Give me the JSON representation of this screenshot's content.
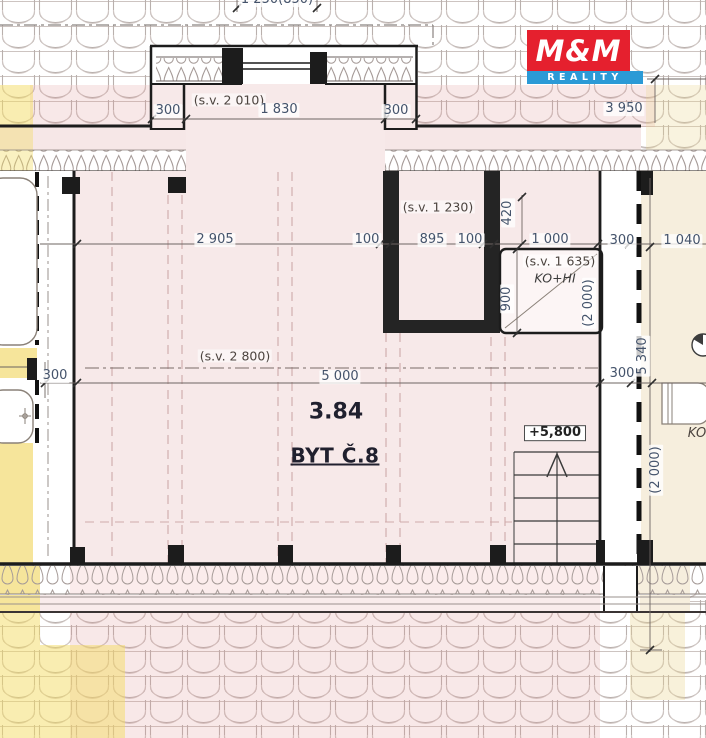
{
  "logo": {
    "name": "M&M",
    "tagline": "REALITY"
  },
  "colors": {
    "logo-red": "#e5202e",
    "logo-blue": "#2b9ad6",
    "plan-pink": "#f7e9e9",
    "accent-yellow": "#f6e59b",
    "room-beige": "#f6eedd",
    "dim-text": "#44536b"
  },
  "labels": {
    "cut_top": "1 250(850)",
    "dim_3950": "3 950",
    "sv_2010": "(s.v. 2 010)",
    "dim_300_dormer_left": "300",
    "dim_1830": "1 830",
    "dim_300_dormer_right": "300",
    "sv_1230": "(s.v. 1 230)",
    "dim_420": "420",
    "dim_2905": "2 905",
    "dim_100_a": "100",
    "dim_895": "895",
    "dim_100_b": "100",
    "dim_1000": "1 000",
    "dim_300_top_right": "300",
    "dim_1040": "1 040",
    "sv_1635": "(s.v. 1 635)",
    "ko_hi": "KO+HI",
    "dim_900": "900",
    "dim_2000_shaft": "(2 000)",
    "sv_2800": "(s.v. 2 800)",
    "dim_300_left": "300",
    "dim_5000": "5 000",
    "dim_300_mid_right": "300",
    "dim_5340": "5 340",
    "dim_2000_right": "(2 000)",
    "area_value": "3.84",
    "unit_label": "BYT Č.8",
    "level_label": "+5,800",
    "room_ko": "KO"
  }
}
